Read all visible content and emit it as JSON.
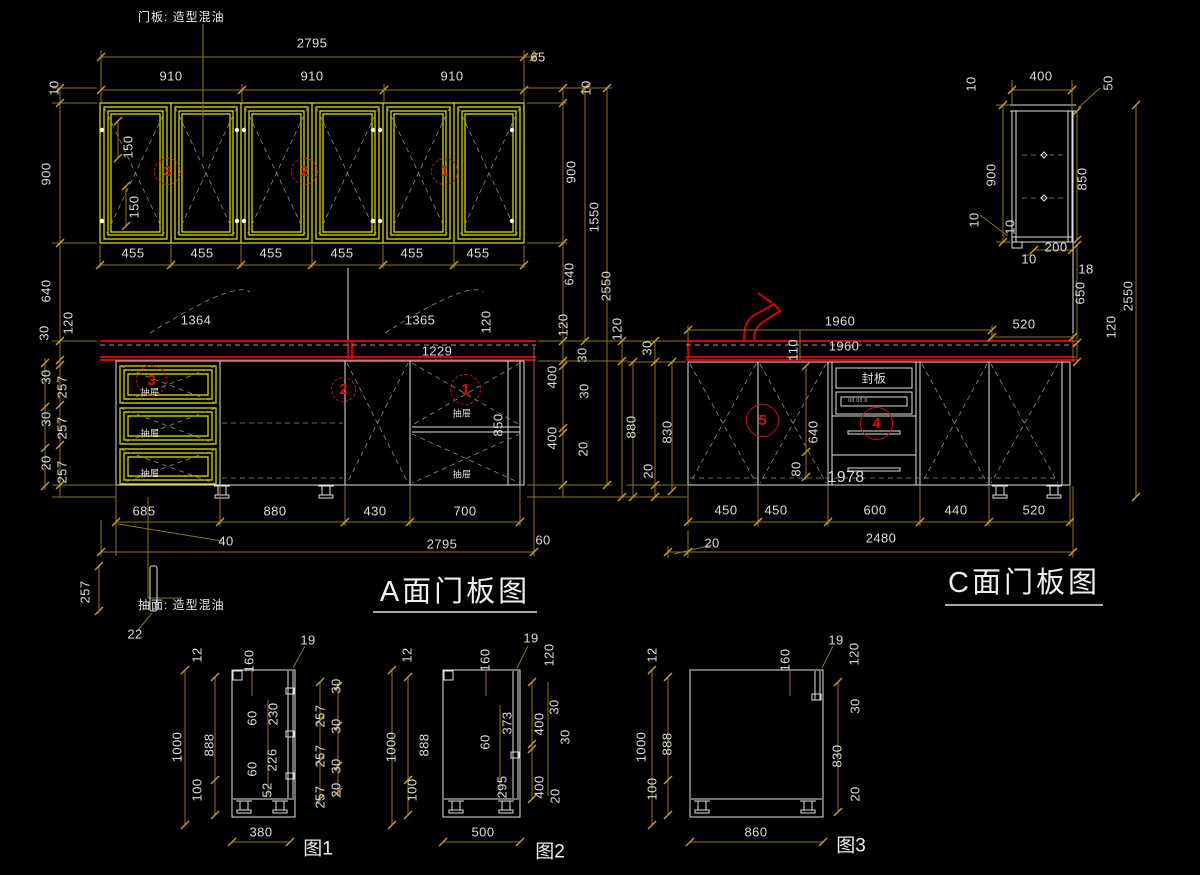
{
  "titles": {
    "view_a": "A面门板图",
    "view_c": "C面门板图"
  },
  "figures": {
    "fig1": "图1",
    "fig2": "图2",
    "fig3": "图3"
  },
  "notes": {
    "door_panel": "门板: 造型混油",
    "drawer_face": "抽面: 造型混油",
    "seal_board": "封板"
  },
  "colors": {
    "background": "#000000",
    "outline_white": "#dfdfdf",
    "door_yellow": "#e6e600",
    "dimension_line": "#8f7420",
    "tick": "#c9992d",
    "countertop_red": "#d40000",
    "callout_red": "#cf1010",
    "text": "#dcdcdc"
  },
  "callouts": [
    {
      "n": "3",
      "x": 168,
      "y": 172,
      "r": 14
    },
    {
      "n": "2",
      "x": 305,
      "y": 172,
      "r": 14
    },
    {
      "n": "1",
      "x": 445,
      "y": 172,
      "r": 14
    },
    {
      "n": "3",
      "x": 152,
      "y": 381,
      "r": 16
    },
    {
      "n": "2",
      "x": 344,
      "y": 390,
      "r": 13
    },
    {
      "n": "1",
      "x": 466,
      "y": 390,
      "r": 16
    },
    {
      "n": "5",
      "x": 763,
      "y": 421,
      "r": 17,
      "solid": 1
    },
    {
      "n": "4",
      "x": 877,
      "y": 424,
      "r": 17,
      "solid": 1
    }
  ],
  "labels": [
    {
      "t": "2795",
      "x": 312,
      "y": 43
    },
    {
      "t": "65",
      "x": 538,
      "y": 57
    },
    {
      "t": "910",
      "x": 171,
      "y": 76
    },
    {
      "t": "910",
      "x": 312,
      "y": 76
    },
    {
      "t": "910",
      "x": 452,
      "y": 76
    },
    {
      "t": "455",
      "x": 133,
      "y": 253
    },
    {
      "t": "455",
      "x": 202,
      "y": 253
    },
    {
      "t": "455",
      "x": 271,
      "y": 253
    },
    {
      "t": "455",
      "x": 342,
      "y": 253
    },
    {
      "t": "455",
      "x": 412,
      "y": 253
    },
    {
      "t": "455",
      "x": 478,
      "y": 253
    },
    {
      "t": "150",
      "x": 128,
      "y": 147,
      "r": 1
    },
    {
      "t": "150",
      "x": 134,
      "y": 207,
      "r": 1
    },
    {
      "t": "10",
      "x": 54,
      "y": 88,
      "r": 1
    },
    {
      "t": "900",
      "x": 46,
      "y": 174,
      "r": 1
    },
    {
      "t": "640",
      "x": 46,
      "y": 291,
      "r": 1
    },
    {
      "t": "120",
      "x": 68,
      "y": 323,
      "r": 1
    },
    {
      "t": "30",
      "x": 44,
      "y": 333,
      "r": 1
    },
    {
      "t": "30",
      "x": 46,
      "y": 377,
      "r": 1
    },
    {
      "t": "257",
      "x": 62,
      "y": 387,
      "r": 1
    },
    {
      "t": "30",
      "x": 46,
      "y": 419,
      "r": 1
    },
    {
      "t": "257",
      "x": 62,
      "y": 428,
      "r": 1
    },
    {
      "t": "20",
      "x": 46,
      "y": 463,
      "r": 1
    },
    {
      "t": "257",
      "x": 62,
      "y": 472,
      "r": 1
    },
    {
      "t": "10",
      "x": 586,
      "y": 88,
      "r": 1
    },
    {
      "t": "900",
      "x": 571,
      "y": 172,
      "r": 1
    },
    {
      "t": "1550",
      "x": 594,
      "y": 217,
      "r": 1
    },
    {
      "t": "640",
      "x": 569,
      "y": 274,
      "r": 1
    },
    {
      "t": "2550",
      "x": 606,
      "y": 286,
      "r": 1
    },
    {
      "t": "120",
      "x": 563,
      "y": 325,
      "r": 1
    },
    {
      "t": "30",
      "x": 582,
      "y": 355,
      "r": 1
    },
    {
      "t": "400",
      "x": 552,
      "y": 377,
      "r": 1
    },
    {
      "t": "30",
      "x": 584,
      "y": 391,
      "r": 1
    },
    {
      "t": "400",
      "x": 552,
      "y": 438,
      "r": 1
    },
    {
      "t": "20",
      "x": 583,
      "y": 449,
      "r": 1
    },
    {
      "t": "120",
      "x": 617,
      "y": 329,
      "r": 1
    },
    {
      "t": "880",
      "x": 631,
      "y": 427,
      "r": 1
    },
    {
      "t": "1364",
      "x": 196,
      "y": 320
    },
    {
      "t": "1365",
      "x": 420,
      "y": 320
    },
    {
      "t": "1229",
      "x": 437,
      "y": 351
    },
    {
      "t": "120",
      "x": 486,
      "y": 322,
      "r": 1
    },
    {
      "t": "850",
      "x": 498,
      "y": 425,
      "r": 1
    },
    {
      "t": "抽屉",
      "x": 150,
      "y": 392,
      "s": 9
    },
    {
      "t": "抽屉",
      "x": 150,
      "y": 433,
      "s": 9
    },
    {
      "t": "抽屉",
      "x": 150,
      "y": 473,
      "s": 9
    },
    {
      "t": "抽屉",
      "x": 462,
      "y": 413,
      "s": 9
    },
    {
      "t": "抽屉",
      "x": 462,
      "y": 474,
      "s": 9
    },
    {
      "t": "685",
      "x": 144,
      "y": 511
    },
    {
      "t": "880",
      "x": 275,
      "y": 511
    },
    {
      "t": "430",
      "x": 375,
      "y": 511
    },
    {
      "t": "700",
      "x": 465,
      "y": 511
    },
    {
      "t": "40",
      "x": 226,
      "y": 541
    },
    {
      "t": "2795",
      "x": 442,
      "y": 544
    },
    {
      "t": "60",
      "x": 543,
      "y": 540
    },
    {
      "t": "257",
      "x": 85,
      "y": 592,
      "r": 1
    },
    {
      "t": "22",
      "x": 135,
      "y": 634
    },
    {
      "t": "400",
      "x": 1041,
      "y": 76
    },
    {
      "t": "10",
      "x": 971,
      "y": 84,
      "r": 1
    },
    {
      "t": "50",
      "x": 1108,
      "y": 83,
      "r": 1
    },
    {
      "t": "900",
      "x": 991,
      "y": 175,
      "r": 1
    },
    {
      "t": "850",
      "x": 1082,
      "y": 179,
      "r": 1
    },
    {
      "t": "10",
      "x": 974,
      "y": 220,
      "r": 1
    },
    {
      "t": "10",
      "x": 1010,
      "y": 227,
      "r": 1
    },
    {
      "t": "200",
      "x": 1056,
      "y": 247
    },
    {
      "t": "10",
      "x": 1029,
      "y": 259
    },
    {
      "t": "18",
      "x": 1086,
      "y": 269
    },
    {
      "t": "650",
      "x": 1080,
      "y": 293,
      "r": 1
    },
    {
      "t": "2550",
      "x": 1128,
      "y": 296,
      "r": 1
    },
    {
      "t": "120",
      "x": 1111,
      "y": 327,
      "r": 1
    },
    {
      "t": "520",
      "x": 1024,
      "y": 324
    },
    {
      "t": "1960",
      "x": 840,
      "y": 321
    },
    {
      "t": "1960",
      "x": 844,
      "y": 346
    },
    {
      "t": "110",
      "x": 793,
      "y": 350,
      "r": 1
    },
    {
      "t": "30",
      "x": 647,
      "y": 348,
      "r": 1
    },
    {
      "t": "830",
      "x": 667,
      "y": 432,
      "r": 1
    },
    {
      "t": "20",
      "x": 648,
      "y": 471,
      "r": 1
    },
    {
      "t": "640",
      "x": 813,
      "y": 432,
      "r": 1
    },
    {
      "t": "80",
      "x": 796,
      "y": 469,
      "r": 1
    },
    {
      "t": "1978",
      "x": 846,
      "y": 478,
      "s": 16
    },
    {
      "t": "00 00 0",
      "x": 858,
      "y": 401,
      "s": 5
    },
    {
      "t": "450",
      "x": 726,
      "y": 510
    },
    {
      "t": "450",
      "x": 776,
      "y": 510
    },
    {
      "t": "600",
      "x": 875,
      "y": 510
    },
    {
      "t": "440",
      "x": 956,
      "y": 510
    },
    {
      "t": "520",
      "x": 1034,
      "y": 510
    },
    {
      "t": "2480",
      "x": 881,
      "y": 538
    },
    {
      "t": "20",
      "x": 712,
      "y": 543
    },
    {
      "t": "12",
      "x": 197,
      "y": 655,
      "r": 1
    },
    {
      "t": "1000",
      "x": 177,
      "y": 747,
      "r": 1
    },
    {
      "t": "888",
      "x": 209,
      "y": 745,
      "r": 1
    },
    {
      "t": "100",
      "x": 197,
      "y": 790,
      "r": 1
    },
    {
      "t": "160",
      "x": 249,
      "y": 661,
      "r": 1
    },
    {
      "t": "19",
      "x": 308,
      "y": 640
    },
    {
      "t": "60",
      "x": 252,
      "y": 718,
      "r": 1
    },
    {
      "t": "230",
      "x": 273,
      "y": 714,
      "r": 1
    },
    {
      "t": "60",
      "x": 252,
      "y": 769,
      "r": 1
    },
    {
      "t": "226",
      "x": 272,
      "y": 760,
      "r": 1
    },
    {
      "t": "52",
      "x": 267,
      "y": 790,
      "r": 1
    },
    {
      "t": "30",
      "x": 336,
      "y": 686,
      "r": 1
    },
    {
      "t": "257",
      "x": 320,
      "y": 716,
      "r": 1
    },
    {
      "t": "30",
      "x": 336,
      "y": 726,
      "r": 1
    },
    {
      "t": "257",
      "x": 320,
      "y": 756,
      "r": 1
    },
    {
      "t": "30",
      "x": 336,
      "y": 766,
      "r": 1
    },
    {
      "t": "257",
      "x": 320,
      "y": 797,
      "r": 1
    },
    {
      "t": "20",
      "x": 336,
      "y": 790,
      "r": 1
    },
    {
      "t": "380",
      "x": 261,
      "y": 832
    },
    {
      "t": "12",
      "x": 407,
      "y": 655,
      "r": 1
    },
    {
      "t": "1000",
      "x": 391,
      "y": 747,
      "r": 1
    },
    {
      "t": "888",
      "x": 424,
      "y": 745,
      "r": 1
    },
    {
      "t": "100",
      "x": 412,
      "y": 790,
      "r": 1
    },
    {
      "t": "160",
      "x": 485,
      "y": 660,
      "r": 1
    },
    {
      "t": "19",
      "x": 531,
      "y": 638
    },
    {
      "t": "120",
      "x": 549,
      "y": 655,
      "r": 1
    },
    {
      "t": "373",
      "x": 507,
      "y": 723,
      "r": 1
    },
    {
      "t": "60",
      "x": 485,
      "y": 742,
      "r": 1
    },
    {
      "t": "295",
      "x": 502,
      "y": 787,
      "r": 1
    },
    {
      "t": "30",
      "x": 554,
      "y": 707,
      "r": 1
    },
    {
      "t": "400",
      "x": 539,
      "y": 724,
      "r": 1
    },
    {
      "t": "30",
      "x": 565,
      "y": 737,
      "r": 1
    },
    {
      "t": "400",
      "x": 539,
      "y": 787,
      "r": 1
    },
    {
      "t": "20",
      "x": 555,
      "y": 796,
      "r": 1
    },
    {
      "t": "500",
      "x": 483,
      "y": 832
    },
    {
      "t": "12",
      "x": 652,
      "y": 655,
      "r": 1
    },
    {
      "t": "1000",
      "x": 641,
      "y": 747,
      "r": 1
    },
    {
      "t": "888",
      "x": 667,
      "y": 744,
      "r": 1
    },
    {
      "t": "100",
      "x": 652,
      "y": 789,
      "r": 1
    },
    {
      "t": "160",
      "x": 785,
      "y": 660,
      "r": 1
    },
    {
      "t": "19",
      "x": 836,
      "y": 640
    },
    {
      "t": "120",
      "x": 854,
      "y": 654,
      "r": 1
    },
    {
      "t": "30",
      "x": 855,
      "y": 706,
      "r": 1
    },
    {
      "t": "830",
      "x": 837,
      "y": 756,
      "r": 1
    },
    {
      "t": "20",
      "x": 855,
      "y": 794,
      "r": 1
    },
    {
      "t": "860",
      "x": 756,
      "y": 832
    }
  ]
}
